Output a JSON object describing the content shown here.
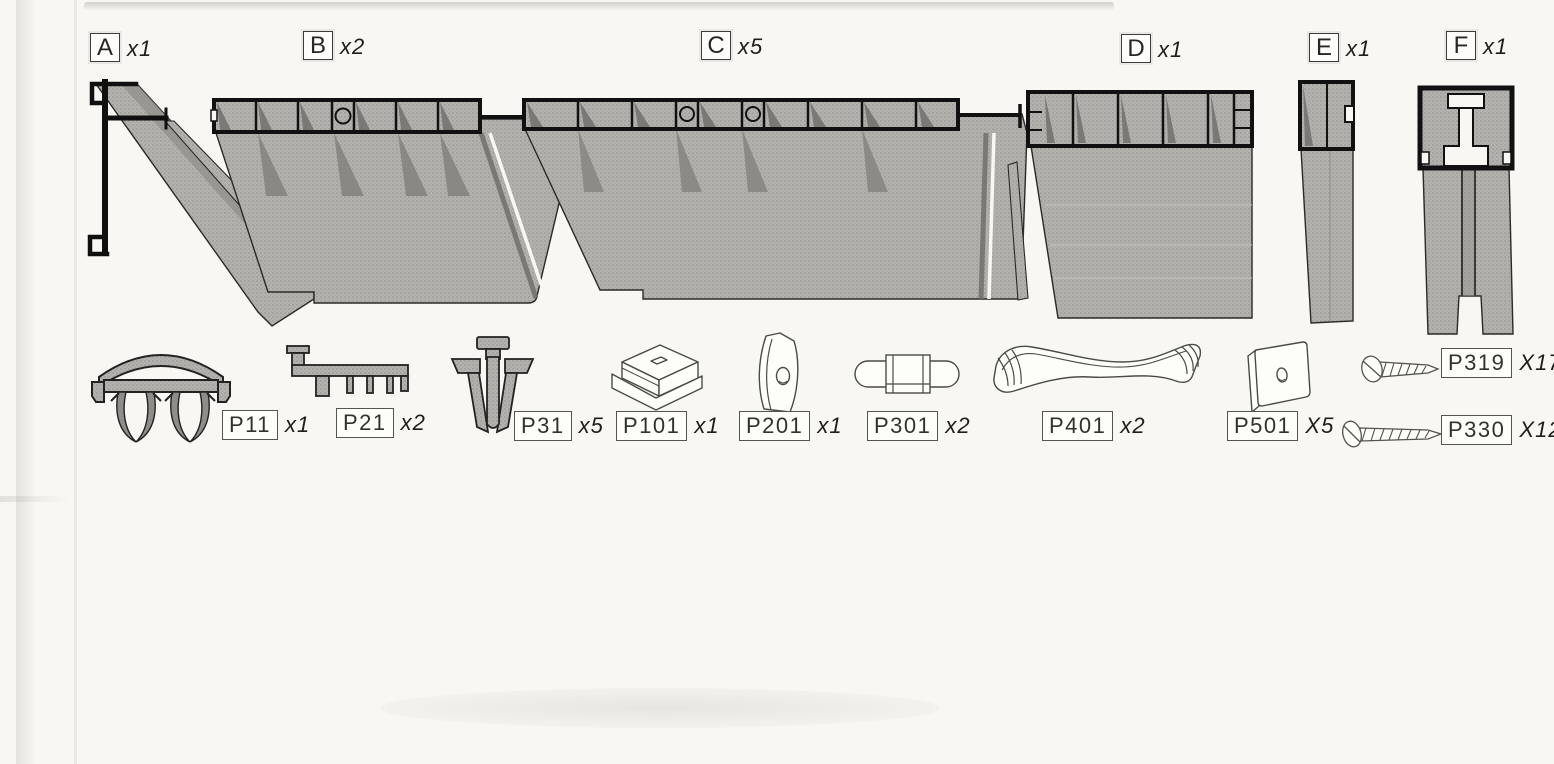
{
  "document": {
    "kind": "assembly parts inventory diagram (scanned instruction sheet)"
  },
  "colors": {
    "paper": "#f8f7f3",
    "profile_fill": "#b2b0ad",
    "profile_shadow": "#84827f",
    "outline_heavy": "#111111",
    "outline_light": "#4a4a46",
    "label_border": "#56544f"
  },
  "profiles": [
    {
      "id": "A",
      "count": "x1"
    },
    {
      "id": "B",
      "count": "x2"
    },
    {
      "id": "C",
      "count": "x5"
    },
    {
      "id": "D",
      "count": "x1"
    },
    {
      "id": "E",
      "count": "x1"
    },
    {
      "id": "F",
      "count": "x1"
    }
  ],
  "hardware": [
    {
      "code": "P11",
      "count": "x1"
    },
    {
      "code": "P21",
      "count": "x2"
    },
    {
      "code": "P31",
      "count": "x5"
    },
    {
      "code": "P101",
      "count": "x1"
    },
    {
      "code": "P201",
      "count": "x1"
    },
    {
      "code": "P301",
      "count": "x2"
    },
    {
      "code": "P401",
      "count": "x2"
    },
    {
      "code": "P501",
      "count": "X5"
    },
    {
      "code": "P319",
      "count": "X17"
    },
    {
      "code": "P330",
      "count": "X12"
    }
  ]
}
